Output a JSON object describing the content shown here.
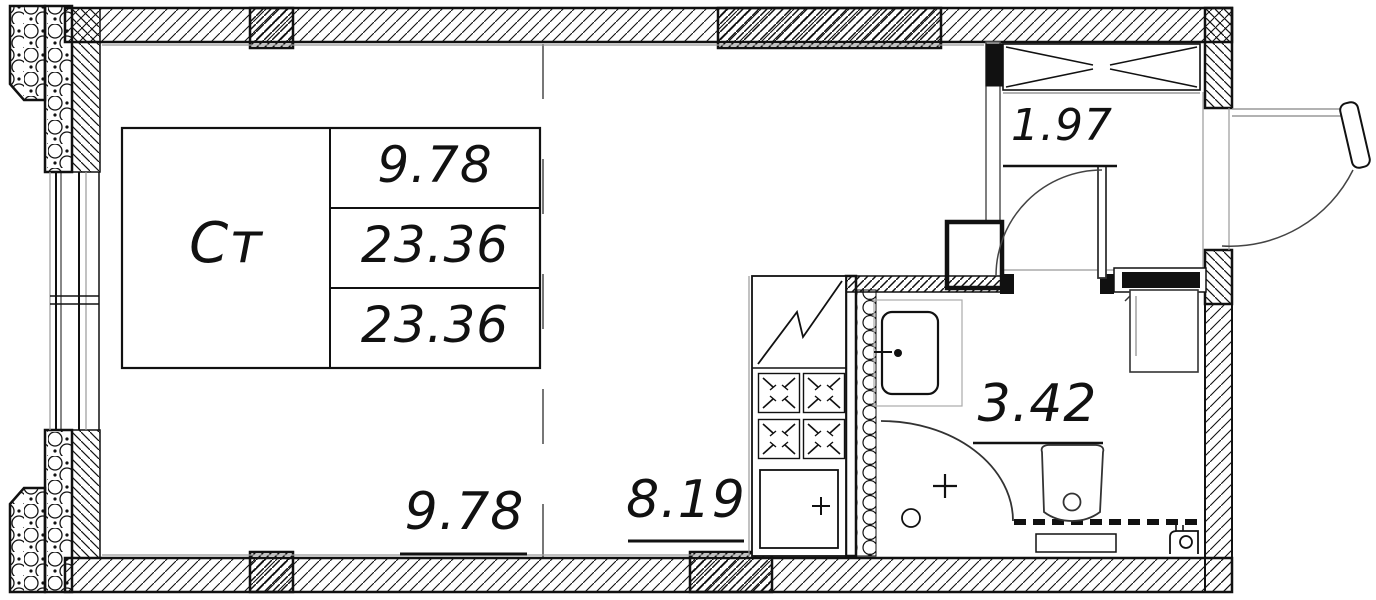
{
  "plan": {
    "title": "Studio apartment floor plan",
    "table": {
      "unit_type": "Ст",
      "rows": [
        "9.78",
        "23.36",
        "23.36"
      ]
    },
    "areas": {
      "living": "9.78",
      "kitchen": "8.19",
      "hall": "1.97",
      "bathroom": "3.42"
    }
  },
  "colors": {
    "line": "#111111",
    "thin_gray": "#909090",
    "background": "#ffffff"
  },
  "fixtures": [
    "window",
    "wardrobe",
    "entrance-door",
    "bathroom-door",
    "refrigerator",
    "stove",
    "kitchen-sink",
    "bathroom-sink",
    "shower",
    "toilet",
    "washing-machine",
    "vent-shaft",
    "towel-dryer"
  ]
}
